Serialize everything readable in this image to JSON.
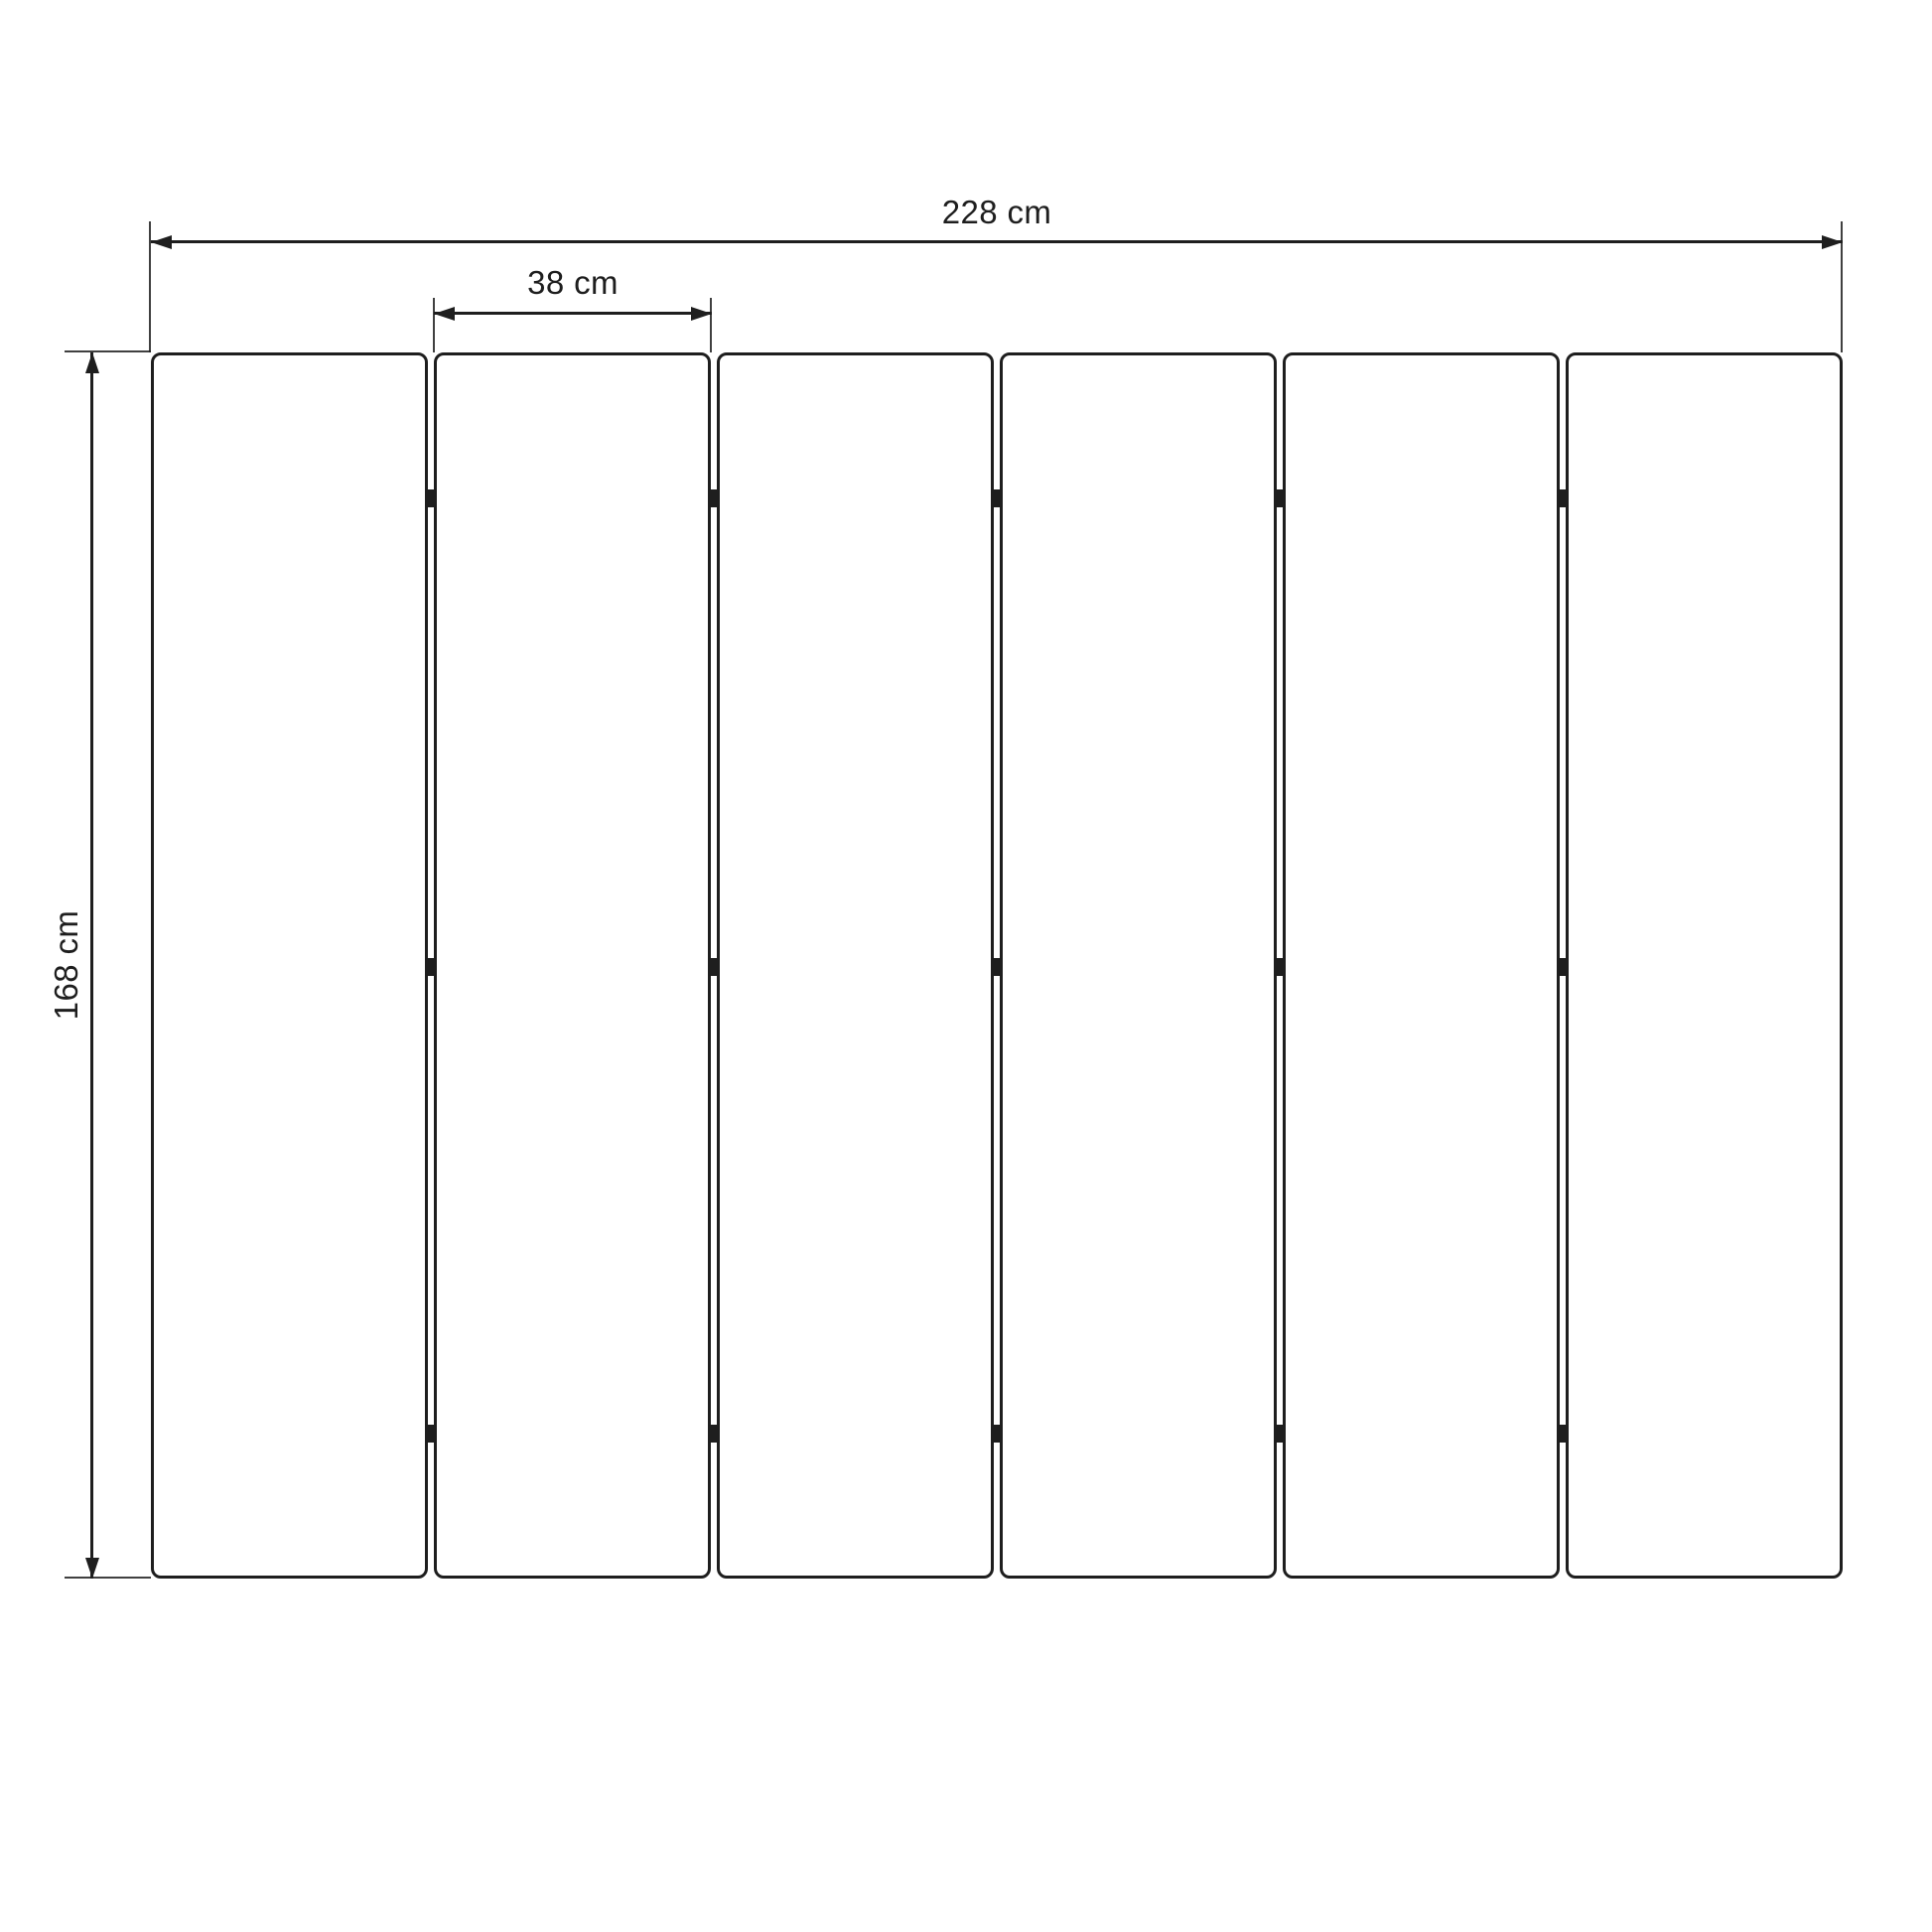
{
  "diagram": {
    "kind": "folding-screen-technical-drawing",
    "panel_count": 6,
    "joint_count": 5,
    "hinges_per_joint": 3,
    "dimensions": {
      "total_width": {
        "label": "228 cm"
      },
      "panel_width": {
        "label": "38 cm"
      },
      "height": {
        "label": "168 cm"
      }
    },
    "colors": {
      "ink": "#1e1e1e",
      "background": "#ffffff"
    }
  }
}
